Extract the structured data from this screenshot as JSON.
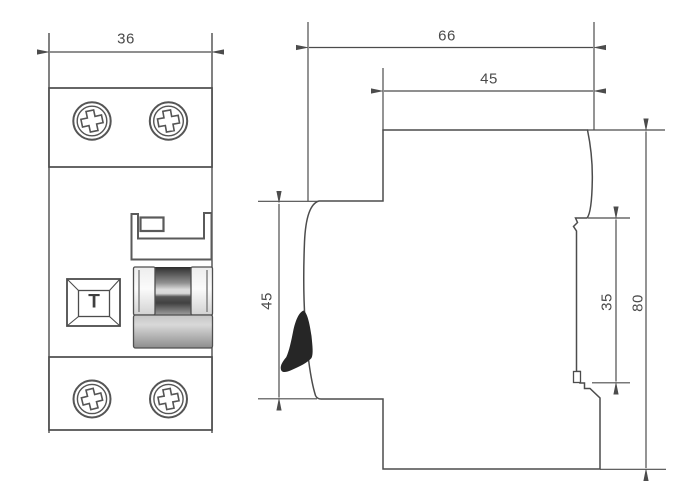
{
  "drawing": {
    "views": {
      "front": {
        "width_label": "36",
        "test_button_label": "T"
      },
      "side": {
        "overall_depth_label": "66",
        "upper_body_depth_label": "45",
        "front_section_height_label": "45",
        "din_rail_recess_label": "35",
        "overall_height_label": "80"
      }
    },
    "colors": {
      "line": "#4c4c4c",
      "background": "#ffffff",
      "lever": "#262626"
    },
    "icons": {
      "terminal_screws": "phillips-screw-icon",
      "test_button": "test-button-square",
      "toggle": "toggle-switch-handle"
    }
  }
}
